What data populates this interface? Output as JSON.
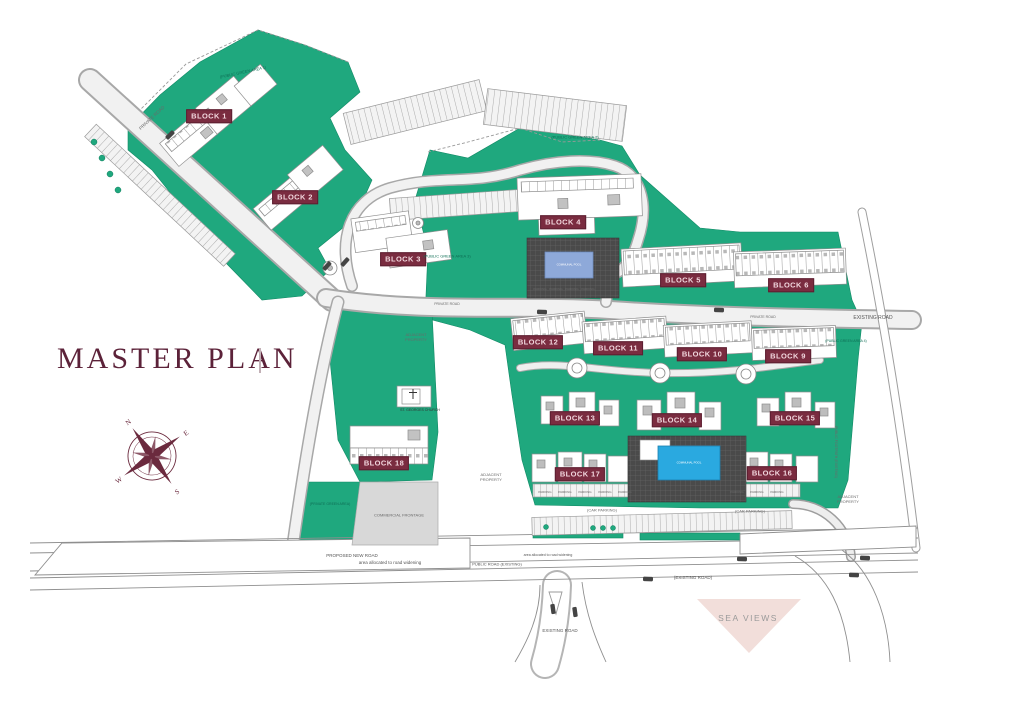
{
  "title": "MASTER PLAN",
  "compass": {
    "n": "N",
    "e": "E",
    "s": "S",
    "w": "W"
  },
  "blocks": [
    {
      "label": "BLOCK 1"
    },
    {
      "label": "BLOCK 2"
    },
    {
      "label": "BLOCK 3"
    },
    {
      "label": "BLOCK 4"
    },
    {
      "label": "BLOCK 5"
    },
    {
      "label": "BLOCK 6"
    },
    {
      "label": "BLOCK 9"
    },
    {
      "label": "BLOCK 10"
    },
    {
      "label": "BLOCK 11"
    },
    {
      "label": "BLOCK 12"
    },
    {
      "label": "BLOCK 13"
    },
    {
      "label": "BLOCK 14"
    },
    {
      "label": "BLOCK 15"
    },
    {
      "label": "BLOCK 16"
    },
    {
      "label": "BLOCK 17"
    },
    {
      "label": "BLOCK 18"
    }
  ],
  "labels": {
    "private_road": "PRIVATE ROAD",
    "existing_road": "EXISTING ROAD",
    "existing_road_paren": "(EXISTING ROAD)",
    "proposed_new_road": "PROPOSED NEW ROAD",
    "road_widening": "area allocated to road widening",
    "public_road_existing": "PUBLIC ROAD (EXISTING)",
    "public_footpath": "PUBLIC FOOTPATH (EXISTING)",
    "commercial_frontage": "COMMERCIAL FRONTAGE",
    "private_green_area": "(PRIVATE GREEN AREA)",
    "public_green_area_1": "(PUBLIC GREEN AREA 1)",
    "public_green_area_2": "(PUBLIC GREEN AREA 2)",
    "public_green_area_3": "(PUBLIC GREEN AREA 3)",
    "public_green_area_4": "(PUBLIC GREEN AREA 4)",
    "adjacent_property": "ADJACENT PROPERTY",
    "car_parking": "(CAR PARKING)",
    "parking": "PARKING",
    "church": "ST. GEORGES CHURCH",
    "sea_views": "SEA VIEWS",
    "communal_pool": "COMMUNAL POOL"
  },
  "colors": {
    "green": "#1FA87E",
    "maroon_label": "#7A2C40",
    "title_maroon": "#5C2239",
    "pool_light_blue": "#8EA9D9",
    "pool_blue": "#2AA9E0",
    "sea_views_pink": "#F2DEDA"
  }
}
